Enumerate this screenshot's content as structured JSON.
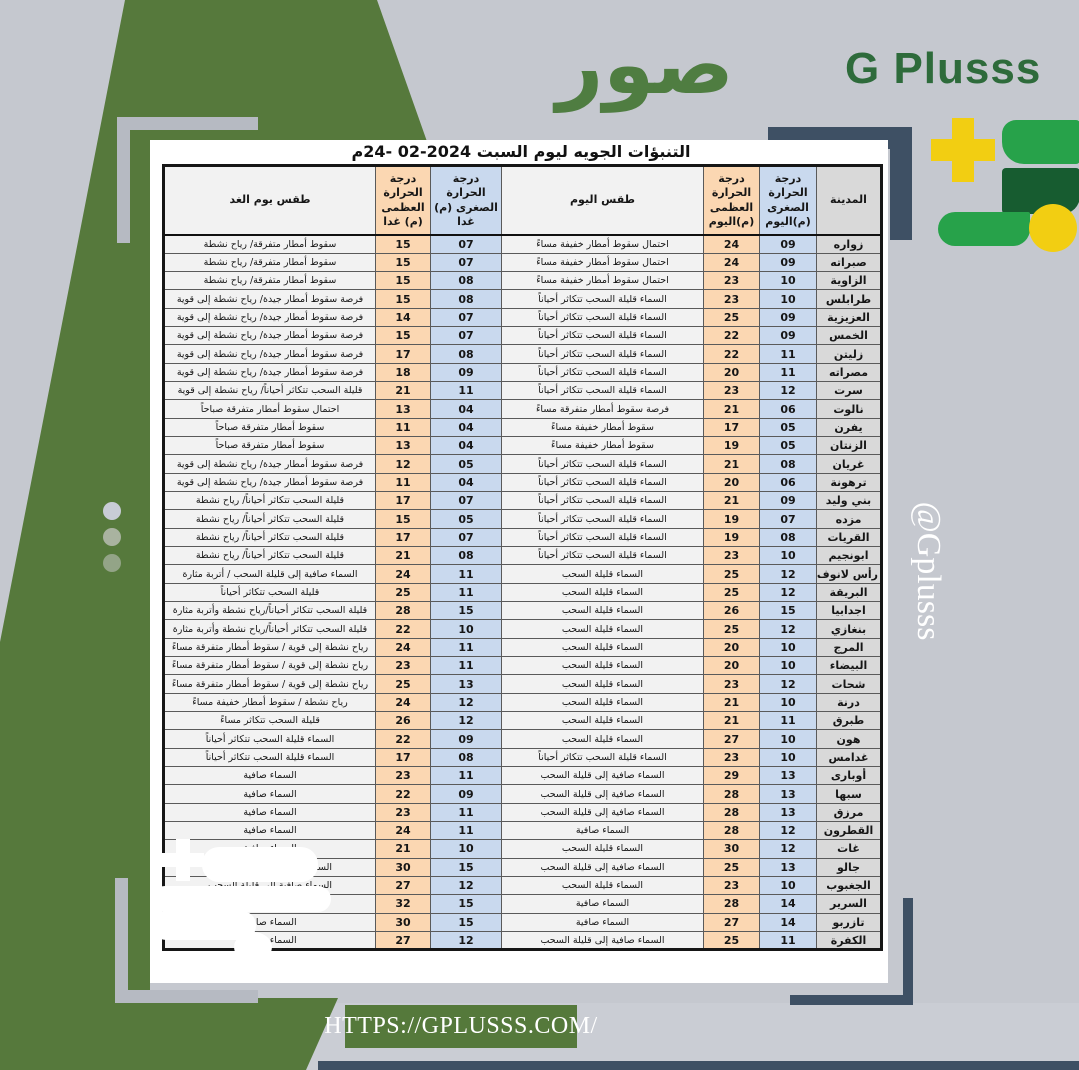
{
  "branding": {
    "logo_text": "صور",
    "brand_name": "G Plusss",
    "handle": "@Gplusss",
    "website": "HTTPS://GPLUSSS.COM/",
    "colors": {
      "olive_green": "#56793c",
      "brand_green_dark": "#2e6b3b",
      "logo_bright_green": "#27a24a",
      "logo_deep_green": "#175c30",
      "logo_yellow": "#f2ce12",
      "navy": "#3e5064",
      "background_gray": "#c5c8cf"
    }
  },
  "table": {
    "title": "التنبؤات الجويه ليوم السبت",
    "title_date": "24- 02-2024",
    "title_suffix": "م",
    "headers": {
      "city": "المدينة",
      "today_min": "درجة الحرارة الصغرى (م)اليوم",
      "today_max": "درجة الحرارة العظمى (م)اليوم",
      "today_weather": "طقس اليوم",
      "tomorrow_min": "درجة الحرارة الصغرى (م) غدا",
      "tomorrow_max": "درجة الحرارة العظمى (م) غدا",
      "tomorrow_weather": "طقس يوم الغد"
    },
    "rows": [
      {
        "city": "زواره",
        "today_min": "09",
        "today_max": "24",
        "today_weather": "احتمال سقوط أمطار خفيفة مساءً",
        "tomorrow_min": "07",
        "tomorrow_max": "15",
        "tomorrow_weather": "سقوط أمطار متفرقة/ رياح نشطة"
      },
      {
        "city": "صبراته",
        "today_min": "09",
        "today_max": "24",
        "today_weather": "احتمال سقوط أمطار خفيفة مساءً",
        "tomorrow_min": "07",
        "tomorrow_max": "15",
        "tomorrow_weather": "سقوط أمطار متفرقة/ رياح نشطة"
      },
      {
        "city": "الزاوية",
        "today_min": "10",
        "today_max": "23",
        "today_weather": "احتمال سقوط أمطار خفيفة مساءً",
        "tomorrow_min": "08",
        "tomorrow_max": "15",
        "tomorrow_weather": "سقوط أمطار متفرقة/ رياح نشطة"
      },
      {
        "city": "طرابلس",
        "today_min": "10",
        "today_max": "23",
        "today_weather": "السماء قليلة السحب تتكاثر أحياناً",
        "tomorrow_min": "08",
        "tomorrow_max": "15",
        "tomorrow_weather": "فرصة سقوط أمطار جيدة/ رياح نشطة إلى قوية"
      },
      {
        "city": "العزيزية",
        "today_min": "09",
        "today_max": "25",
        "today_weather": "السماء قليلة السحب تتكاثر أحياناً",
        "tomorrow_min": "07",
        "tomorrow_max": "14",
        "tomorrow_weather": "فرصة سقوط أمطار جيدة/ رياح نشطة إلى قوية"
      },
      {
        "city": "الخمس",
        "today_min": "09",
        "today_max": "22",
        "today_weather": "السماء قليلة السحب تتكاثر أحياناً",
        "tomorrow_min": "07",
        "tomorrow_max": "15",
        "tomorrow_weather": "فرصة سقوط أمطار جيدة/ رياح نشطة إلى قوية"
      },
      {
        "city": "زليتن",
        "today_min": "11",
        "today_max": "22",
        "today_weather": "السماء قليلة السحب تتكاثر أحياناً",
        "tomorrow_min": "08",
        "tomorrow_max": "17",
        "tomorrow_weather": "فرصة سقوط أمطار جيدة/ رياح نشطة إلى قوية"
      },
      {
        "city": "مصراته",
        "today_min": "11",
        "today_max": "20",
        "today_weather": "السماء قليلة السحب تتكاثر أحياناً",
        "tomorrow_min": "09",
        "tomorrow_max": "18",
        "tomorrow_weather": "فرصة سقوط أمطار جيدة/ رياح نشطة إلى قوية"
      },
      {
        "city": "سرت",
        "today_min": "12",
        "today_max": "23",
        "today_weather": "السماء قليلة السحب تتكاثر أحياناً",
        "tomorrow_min": "11",
        "tomorrow_max": "21",
        "tomorrow_weather": "قليلة السحب تتكاثر أحياناً/ رياح نشطة إلى قوية"
      },
      {
        "city": "نالوت",
        "today_min": "06",
        "today_max": "21",
        "today_weather": "فرصة سقوط أمطار متفرقة مساءً",
        "tomorrow_min": "04",
        "tomorrow_max": "13",
        "tomorrow_weather": "احتمال سقوط أمطار متفرقة صباحاً"
      },
      {
        "city": "يفرن",
        "today_min": "05",
        "today_max": "17",
        "today_weather": "سقوط أمطار خفيفة مساءً",
        "tomorrow_min": "04",
        "tomorrow_max": "11",
        "tomorrow_weather": "سقوط أمطار متفرقة صباحاً"
      },
      {
        "city": "الزنتان",
        "today_min": "05",
        "today_max": "19",
        "today_weather": "سقوط أمطار خفيفة مساءً",
        "tomorrow_min": "04",
        "tomorrow_max": "13",
        "tomorrow_weather": "سقوط أمطار متفرقة صباحاً"
      },
      {
        "city": "غريان",
        "today_min": "08",
        "today_max": "21",
        "today_weather": "السماء قليلة السحب تتكاثر أحياناً",
        "tomorrow_min": "05",
        "tomorrow_max": "12",
        "tomorrow_weather": "فرصة سقوط أمطار جيدة/ رياح نشطة إلى قوية"
      },
      {
        "city": "ترهونة",
        "today_min": "06",
        "today_max": "20",
        "today_weather": "السماء قليلة السحب تتكاثر أحياناً",
        "tomorrow_min": "04",
        "tomorrow_max": "11",
        "tomorrow_weather": "فرصة سقوط أمطار جيدة/ رياح نشطة إلى قوية"
      },
      {
        "city": "بني وليد",
        "today_min": "09",
        "today_max": "21",
        "today_weather": "السماء قليلة السحب تتكاثر أحياناً",
        "tomorrow_min": "07",
        "tomorrow_max": "17",
        "tomorrow_weather": "قليلة السحب تتكاثر أحياناً/ رياح نشطة"
      },
      {
        "city": "مزده",
        "today_min": "07",
        "today_max": "19",
        "today_weather": "السماء قليلة السحب تتكاثر أحياناً",
        "tomorrow_min": "05",
        "tomorrow_max": "15",
        "tomorrow_weather": "قليلة السحب تتكاثر أحياناً/ رياح نشطة"
      },
      {
        "city": "القريات",
        "today_min": "08",
        "today_max": "19",
        "today_weather": "السماء قليلة السحب تتكاثر أحياناً",
        "tomorrow_min": "07",
        "tomorrow_max": "17",
        "tomorrow_weather": "قليلة السحب تتكاثر أحياناً/ رياح نشطة"
      },
      {
        "city": "ابونجيم",
        "today_min": "10",
        "today_max": "23",
        "today_weather": "السماء قليلة السحب تتكاثر أحياناً",
        "tomorrow_min": "08",
        "tomorrow_max": "21",
        "tomorrow_weather": "قليلة السحب تتكاثر أحياناً/ رياح نشطة"
      },
      {
        "city": "رأس لانوف",
        "today_min": "12",
        "today_max": "25",
        "today_weather": "السماء قليلة السحب",
        "tomorrow_min": "11",
        "tomorrow_max": "24",
        "tomorrow_weather": "السماء صافية إلى قليلة السحب / أتربة مثارة"
      },
      {
        "city": "البريقة",
        "today_min": "12",
        "today_max": "25",
        "today_weather": "السماء قليلة السحب",
        "tomorrow_min": "11",
        "tomorrow_max": "25",
        "tomorrow_weather": "قليلة السحب تتكاثر أحياناً"
      },
      {
        "city": "اجدابيا",
        "today_min": "15",
        "today_max": "26",
        "today_weather": "السماء قليلة السحب",
        "tomorrow_min": "15",
        "tomorrow_max": "28",
        "tomorrow_weather": "قليلة السحب تتكاثر أحياناً/رياح نشطة وأتربة مثارة"
      },
      {
        "city": "بنغازي",
        "today_min": "12",
        "today_max": "25",
        "today_weather": "السماء قليلة السحب",
        "tomorrow_min": "10",
        "tomorrow_max": "22",
        "tomorrow_weather": "قليلة السحب تتكاثر أحياناً/رياح نشطة وأتربة مثارة"
      },
      {
        "city": "المرج",
        "today_min": "10",
        "today_max": "20",
        "today_weather": "السماء قليلة السحب",
        "tomorrow_min": "11",
        "tomorrow_max": "24",
        "tomorrow_weather": "رياح نشطة إلى قوية / سقوط أمطار متفرقة مساءً"
      },
      {
        "city": "البيضاء",
        "today_min": "10",
        "today_max": "20",
        "today_weather": "السماء قليلة السحب",
        "tomorrow_min": "11",
        "tomorrow_max": "23",
        "tomorrow_weather": "رياح نشطة إلى قوية / سقوط أمطار متفرقة مساءً"
      },
      {
        "city": "شحات",
        "today_min": "12",
        "today_max": "23",
        "today_weather": "السماء قليلة السحب",
        "tomorrow_min": "13",
        "tomorrow_max": "25",
        "tomorrow_weather": "رياح نشطة إلى قوية / سقوط أمطار متفرقة مساءً"
      },
      {
        "city": "درنة",
        "today_min": "10",
        "today_max": "21",
        "today_weather": "السماء قليلة السحب",
        "tomorrow_min": "12",
        "tomorrow_max": "24",
        "tomorrow_weather": "رياح نشطة / سقوط أمطار خفيفة مساءً"
      },
      {
        "city": "طبرق",
        "today_min": "11",
        "today_max": "21",
        "today_weather": "السماء قليلة السحب",
        "tomorrow_min": "12",
        "tomorrow_max": "26",
        "tomorrow_weather": "قليلة السحب تتكاثر مساءً"
      },
      {
        "city": "هون",
        "today_min": "10",
        "today_max": "27",
        "today_weather": "السماء قليلة السحب",
        "tomorrow_min": "09",
        "tomorrow_max": "22",
        "tomorrow_weather": "السماء قليلة السحب تتكاثر أحياناً"
      },
      {
        "city": "غدامس",
        "today_min": "10",
        "today_max": "23",
        "today_weather": "السماء قليلة السحب تتكاثر أحياناً",
        "tomorrow_min": "08",
        "tomorrow_max": "17",
        "tomorrow_weather": "السماء قليلة السحب تتكاثر أحياناً"
      },
      {
        "city": "أوبارى",
        "today_min": "13",
        "today_max": "29",
        "today_weather": "السماء صافية إلى قليلة السحب",
        "tomorrow_min": "11",
        "tomorrow_max": "23",
        "tomorrow_weather": "السماء صافية"
      },
      {
        "city": "سبها",
        "today_min": "13",
        "today_max": "28",
        "today_weather": "السماء صافية إلى قليلة السحب",
        "tomorrow_min": "09",
        "tomorrow_max": "22",
        "tomorrow_weather": "السماء صافية"
      },
      {
        "city": "مرزق",
        "today_min": "13",
        "today_max": "28",
        "today_weather": "السماء صافية إلى قليلة السحب",
        "tomorrow_min": "11",
        "tomorrow_max": "23",
        "tomorrow_weather": "السماء صافية"
      },
      {
        "city": "القطرون",
        "today_min": "12",
        "today_max": "28",
        "today_weather": "السماء صافية",
        "tomorrow_min": "11",
        "tomorrow_max": "24",
        "tomorrow_weather": "السماء صافية"
      },
      {
        "city": "غات",
        "today_min": "12",
        "today_max": "30",
        "today_weather": "السماء قليلة السحب",
        "tomorrow_min": "10",
        "tomorrow_max": "21",
        "tomorrow_weather": "السماء صافية"
      },
      {
        "city": "جالو",
        "today_min": "13",
        "today_max": "25",
        "today_weather": "السماء صافية إلى قليلة السحب",
        "tomorrow_min": "15",
        "tomorrow_max": "30",
        "tomorrow_weather": "السماء صافية إلى قليلة السحب"
      },
      {
        "city": "الجغبوب",
        "today_min": "10",
        "today_max": "23",
        "today_weather": "السماء قليلة السحب",
        "tomorrow_min": "12",
        "tomorrow_max": "27",
        "tomorrow_weather": "السماء صافية إلى قليلة السحب"
      },
      {
        "city": "السرير",
        "today_min": "14",
        "today_max": "28",
        "today_weather": "السماء صافية",
        "tomorrow_min": "15",
        "tomorrow_max": "32",
        "tomorrow_weather": "السماء صافية"
      },
      {
        "city": "تازربو",
        "today_min": "14",
        "today_max": "27",
        "today_weather": "السماء صافية",
        "tomorrow_min": "15",
        "tomorrow_max": "30",
        "tomorrow_weather": "السماء صافية"
      },
      {
        "city": "الكفرة",
        "today_min": "11",
        "today_max": "25",
        "today_weather": "السماء صافية إلى قليلة السحب",
        "tomorrow_min": "12",
        "tomorrow_max": "27",
        "tomorrow_weather": "السماء صافية"
      }
    ]
  }
}
